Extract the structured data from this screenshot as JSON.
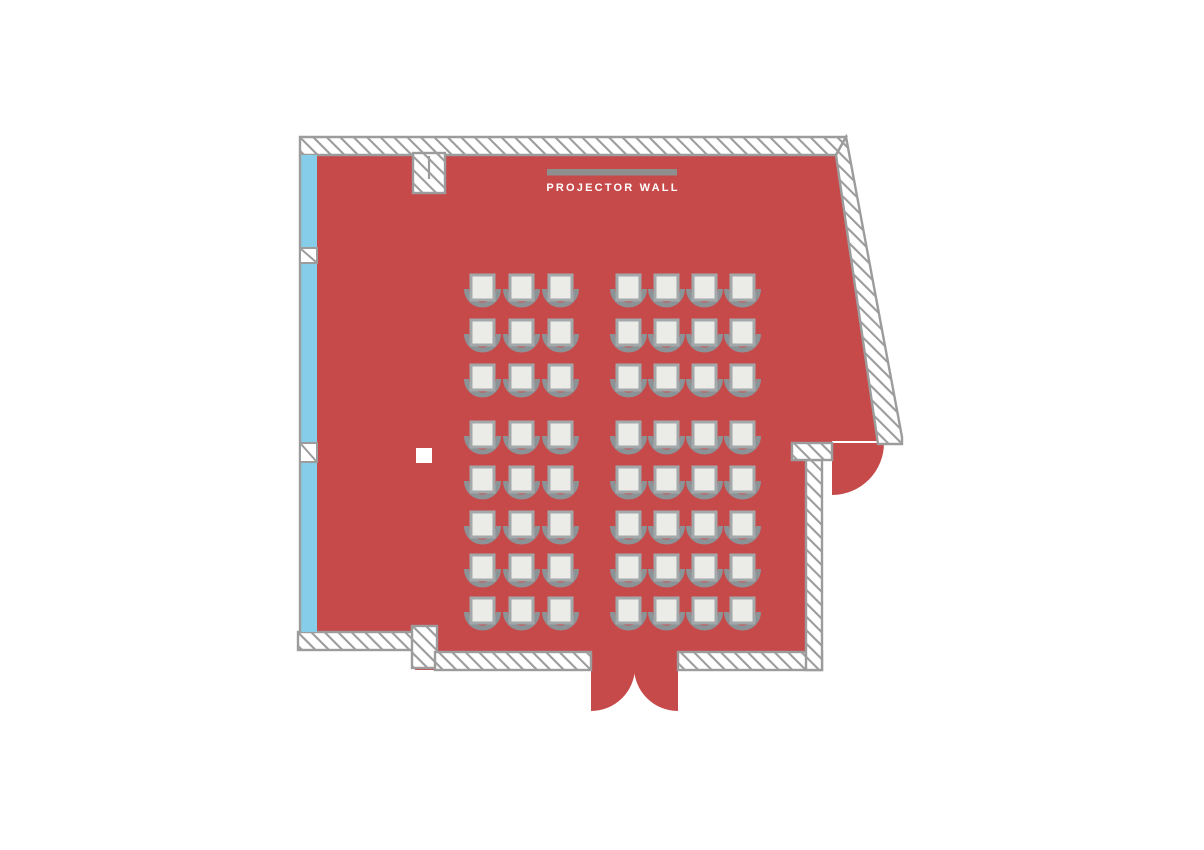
{
  "title": "Event room floor plan",
  "projector": {
    "label": "PROJECTOR WALL"
  },
  "colors": {
    "room_red": "#C74A4A",
    "window_blue": "#85CDE8",
    "wall_gray": "#9C9C9C",
    "bar_gray": "#8F8F8F",
    "chair_gray": "#8C9396",
    "seat_fill": "#EBEBE8",
    "seat_border": "#A3A8AA"
  },
  "seating": {
    "facing": "projector-wall-top",
    "row_y": [
      287,
      332,
      377,
      434,
      479,
      524,
      567,
      610
    ],
    "blocks": [
      {
        "name": "left-block",
        "col_x": [
          482.5,
          521.5,
          560.5
        ]
      },
      {
        "name": "right-block",
        "col_x": [
          628.5,
          666.5,
          704.5,
          742.5
        ]
      }
    ],
    "rows": 8,
    "seats_per_row": 7,
    "total_seats": 56
  },
  "features": {
    "window_wall": "left",
    "double_door": "bottom",
    "single_door": "right",
    "projector_bar": "top-center"
  }
}
